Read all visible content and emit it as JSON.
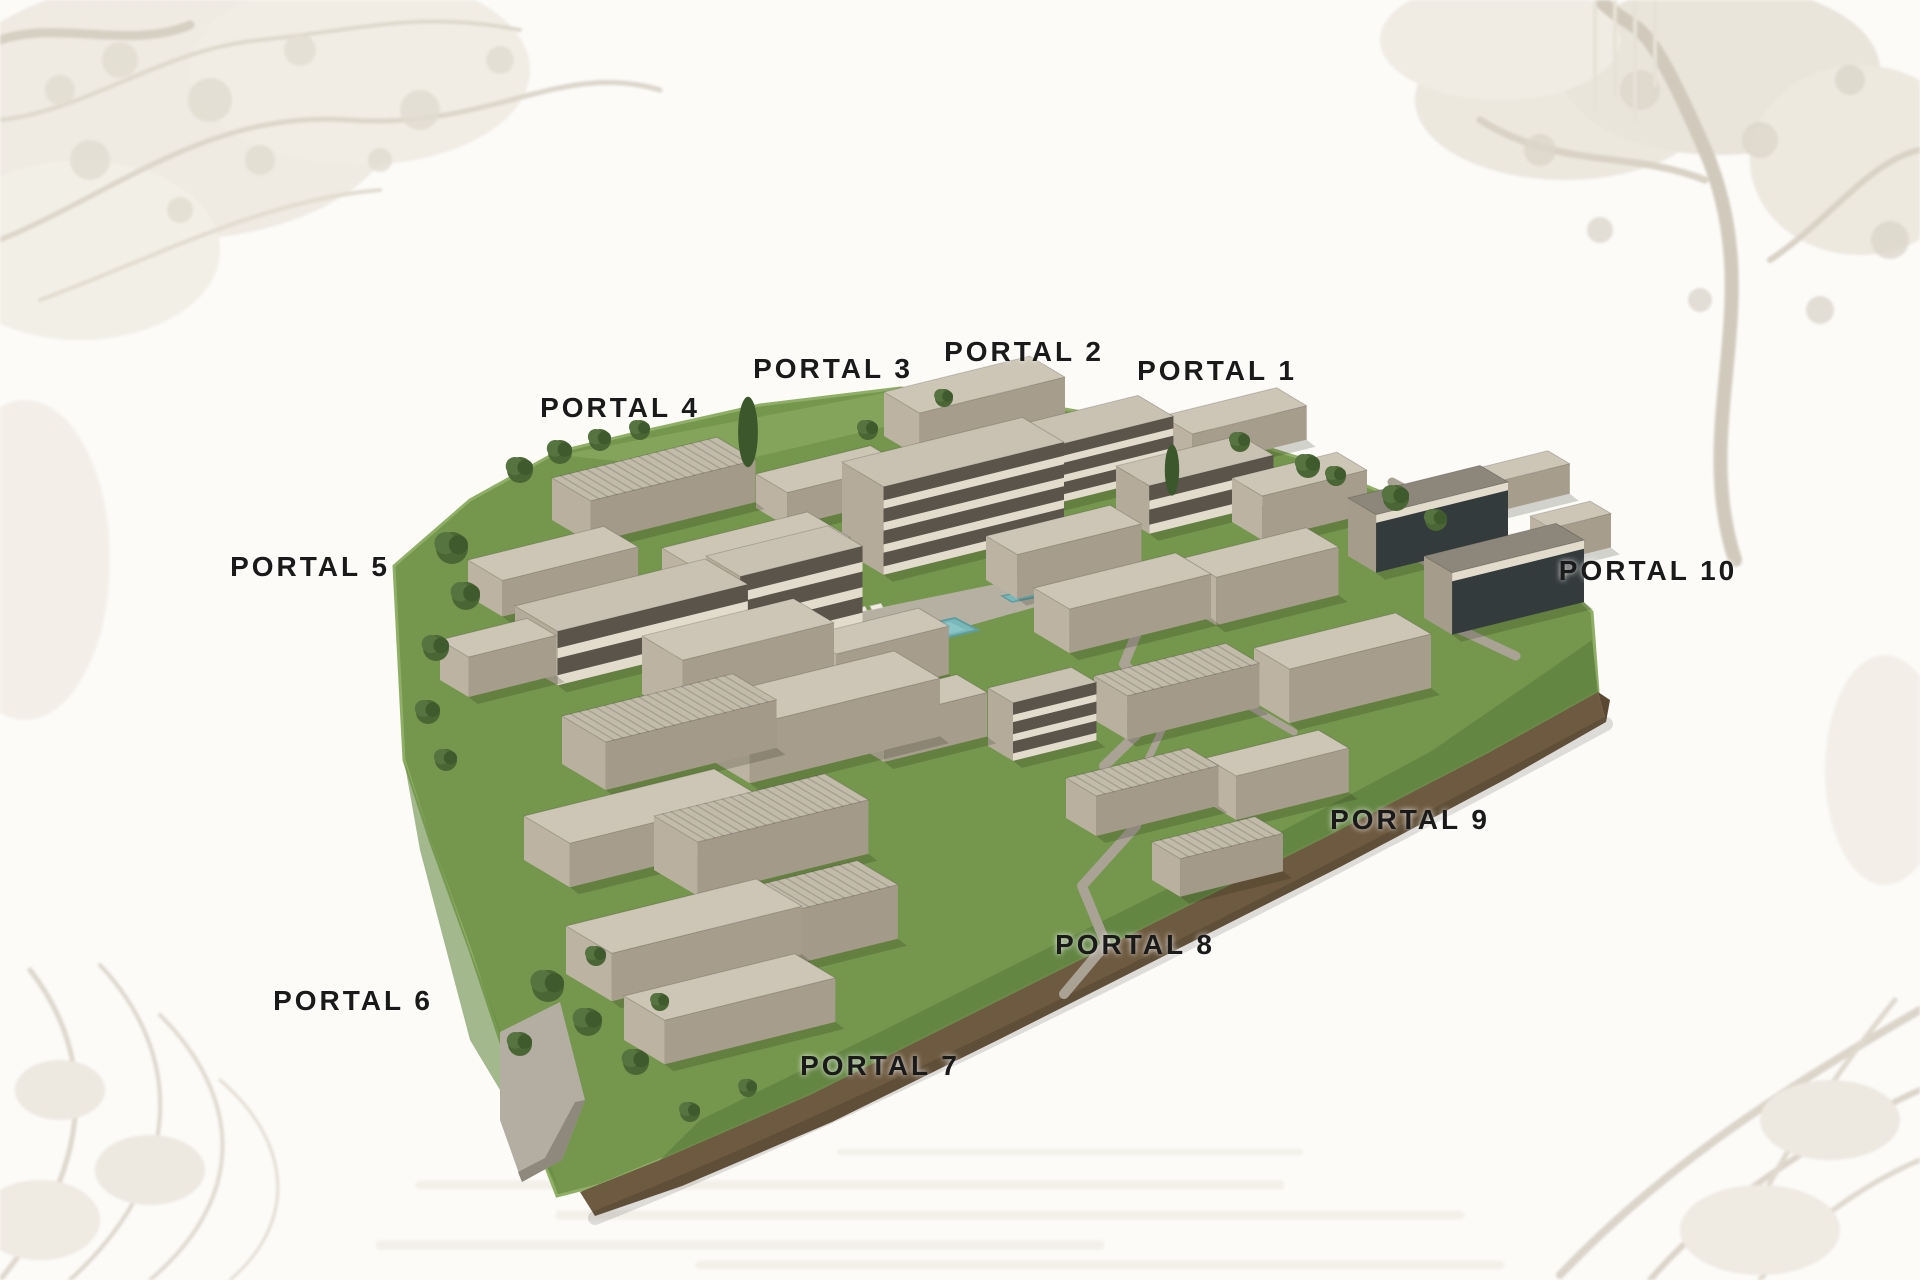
{
  "page": {
    "title": "Residential complex aerial masterplan"
  },
  "portals": [
    {
      "number": 1,
      "label": "PORTAL 1"
    },
    {
      "number": 2,
      "label": "PORTAL 2"
    },
    {
      "number": 3,
      "label": "PORTAL 3"
    },
    {
      "number": 4,
      "label": "PORTAL 4"
    },
    {
      "number": 5,
      "label": "PORTAL 5"
    },
    {
      "number": 6,
      "label": "PORTAL 6"
    },
    {
      "number": 7,
      "label": "PORTAL 7"
    },
    {
      "number": 8,
      "label": "PORTAL 8"
    },
    {
      "number": 9,
      "label": "PORTAL 9"
    },
    {
      "number": 10,
      "label": "PORTAL 10"
    }
  ],
  "palette": {
    "label_text": "#1a1a1a",
    "background": "#fcfbf8",
    "watermark_sepia": "#d8d1c4",
    "grass": "#74974d",
    "grass_light": "#8fae66",
    "grass_dark": "#5f8040",
    "building_roof": "#cdc6b6",
    "building_front": "#a79d8c",
    "building_side": "#bcb3a2",
    "facade_band_dark": "#5a544b",
    "facade_band_light": "#e3dccd",
    "glass_dark": "#343b3c",
    "pool_water": "#79b7ba",
    "path_gray": "#a9a295",
    "deck_gray": "#b6b0a2",
    "wall_brown": "#6e5a40"
  }
}
